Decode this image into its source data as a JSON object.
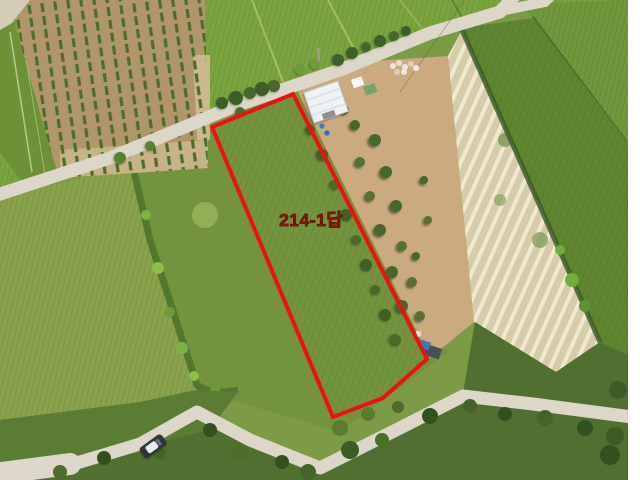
{
  "annotation": {
    "parcel_label": "214-1답",
    "label_color": "#8d140b",
    "boundary_color": "#ee1111"
  },
  "photo": {
    "background_color": "#ffffff",
    "description": "Aerial drone photograph of farmland; a red boundary outlines rice-paddy parcel 214-1 beside a farmstead, orchard strip, plowed field and gravel roads"
  }
}
